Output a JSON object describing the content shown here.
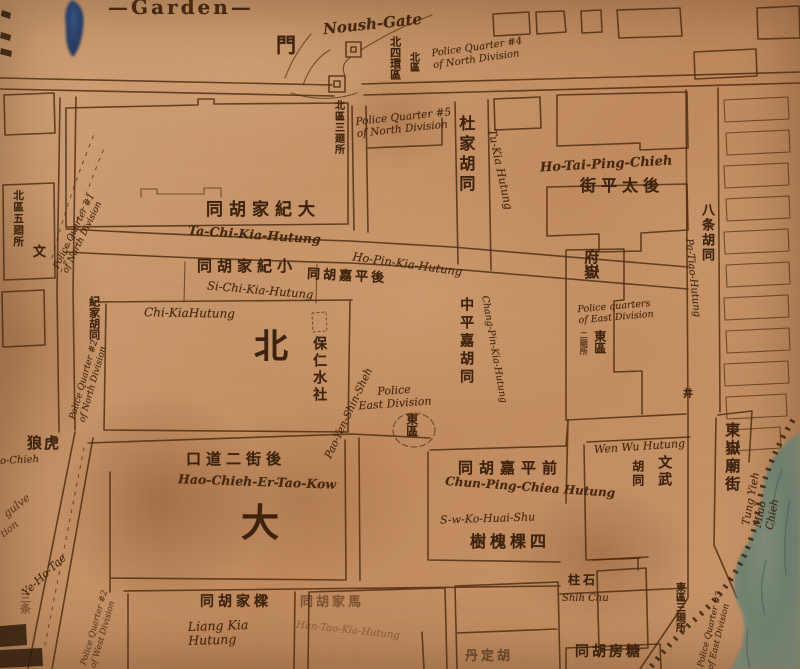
{
  "labels": {
    "garden": "—Garden—",
    "noush_gate": "Noush-Gate",
    "men": "門",
    "q4_north": "Police Quarter #4\nof North Division",
    "beisihuanqu": "北四環區",
    "beiqu_small": "北區",
    "q5_north": "Police Quarter #5\nof North Division",
    "beiqu_san": "北區三廻所",
    "tukia_cjk": "杜家胡同",
    "tukia_rom": "Tu-Kia Hutung",
    "hotaiping_rom": "Ho-Tai-Ping-Chieh",
    "hotaiping_cjk": "街平太後",
    "patiao_cjk": "八条胡同",
    "patiao_rom": "Pa-Tiao-Hutung",
    "fuyue_cjk": "府嶽",
    "q_east": "Police quarters\nof East Division",
    "dongqu_mid": "東區",
    "erhuisuo": "二廻所",
    "tachi_cjk": "同胡家紀大",
    "tachi_rom": "Ta-Chi-Kia-Hutung",
    "sichi_cjk": "同胡家紀小",
    "sichi_rom": "Si-Chi-Kia-Hutung",
    "hopin_rom": "Ho-Pin-Kia-Hutung",
    "houpingjia_cjk": "同胡嘉平後",
    "chikia_rom": "Chi-KiaHutung",
    "chikia_cjk": "紀家胡同",
    "bei_big": "北",
    "paojen_cjk": "保仁水社",
    "paoyen_rom": "Pao-Yen-Shin-Sheh",
    "police_east": "Police\nEast Division",
    "dongqu_circle": "東區",
    "chungping_cjk": "中平嘉胡同",
    "changpin_rom": "Chang-Pin-Kia-Hutung",
    "haochieh_cjk": "口道二街後",
    "haochieh_rom": "Hao-Chieh-Er-Tao-Kow",
    "ta_big": "大",
    "wenwu_rom": "Wen Wu Hutung",
    "wenwu_a": "文武",
    "wenwu_b": "胡同",
    "chunping_cjk": "同胡嘉平前",
    "chunping_rom": "Chun-Ping-Chiea Hutung",
    "suwko_rom": "S-w-Ko-Huai-Shu",
    "sikehuaishu_cjk": "樹槐棵四",
    "shihchu_cjk": "柱石",
    "shihchu_rom": "Shih Chu",
    "dongqu_san": "東區三廻所",
    "q3_east": "Police Quarter #3\nof East Division",
    "tungyieh_cjk": "東嶽廟街",
    "tungyieh_rom": "Tung Yieh Miao Chieh",
    "liangkia_cjk": "同胡家樑",
    "liangkia_rom": "Liang Kia\nHutung",
    "faded_cjk": "同胡家馬",
    "faded_rom": "Han-Tao-Kia-Hutung",
    "tangfang_cjk": "同胡房糖",
    "partial_cjk": "丹定胡",
    "langhu_cjk": "狼虎",
    "hochieh_frag": "o-Chieh",
    "q2_north": "Police Quarter #2\nof North Division",
    "q1_north": "Police Quarter #1\nof North Division",
    "wen": "文",
    "beiquwu": "北區五廻所",
    "gulve_frag": "gulve",
    "tion_frag": "tion",
    "yehotae_rom": "Ye-Ho-Tae",
    "santiao_cjk": "三条",
    "q_west": "Police Quarter #2\nof West Division",
    "jing": "井"
  }
}
